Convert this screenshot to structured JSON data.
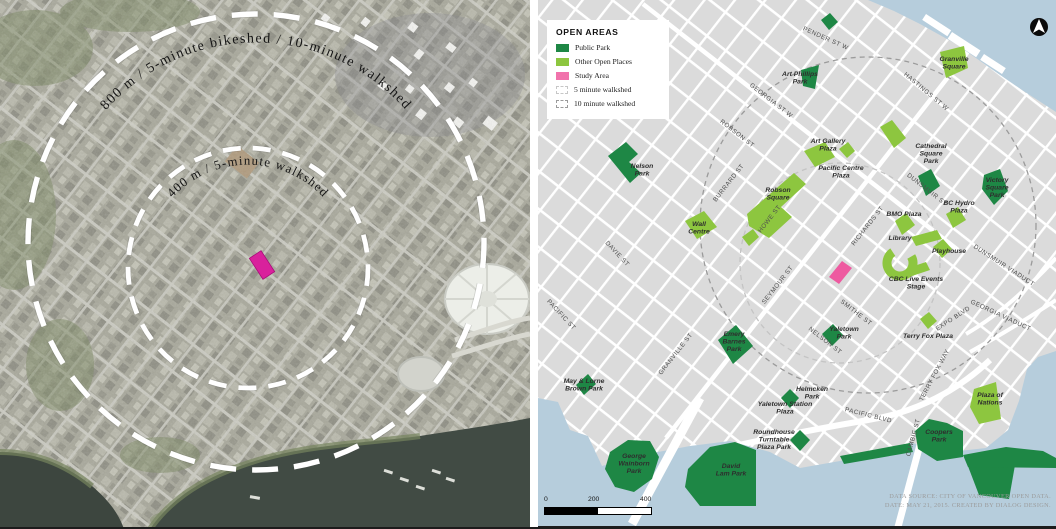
{
  "left_panel": {
    "outer_circle_label": "800 m / 5-minute bikeshed / 10-minute walkshed",
    "inner_circle_label": "400 m / 5-minute walkshed"
  },
  "legend": {
    "title": "OPEN AREAS",
    "items": [
      {
        "label": "Public Park",
        "swatch": "#1e8745"
      },
      {
        "label": "Other Open Places",
        "swatch": "#8dc63f"
      },
      {
        "label": "Study Area",
        "swatch": "#f173ac"
      },
      {
        "label": "5 minute walkshed",
        "swatch": "dashed-light"
      },
      {
        "label": "10 minute walkshed",
        "swatch": "dashed-dark"
      }
    ]
  },
  "map": {
    "street_labels": [
      "PENDER ST W",
      "HASTINGS ST W",
      "GEORGIA ST W",
      "ROBSON ST",
      "DUNSMUIR ST",
      "SMITHE ST",
      "NELSON ST",
      "DAVIE ST",
      "PACIFIC ST",
      "PACIFIC BLVD",
      "EXPO BLVD",
      "BURRARD ST",
      "HOWE ST",
      "SEYMOUR ST",
      "RICHARDS ST",
      "GRANVILLE ST",
      "CAMBIE ST",
      "TERRY FOX WAY",
      "DUNSMUIR VIADUCT",
      "GEORGIA VIADUCT"
    ],
    "public_parks": [
      "Art Phillips\nPark",
      "Nelson\nPark",
      "Cathedral\nSquare\nPark",
      "Victory\nSquare\nPark",
      "Emery\nBarnes\nPark",
      "Yaletown\nPark",
      "Helmcken\nPark",
      "May & Lorne\nBrown Park",
      "George\nWainborn\nPark",
      "David\nLam Park",
      "Coopers\nPark",
      "Roundhouse\nTurntable\nPlaza Park",
      "Yaletown Station\nPlaza"
    ],
    "open_places": [
      "Granville\nSquare",
      "Art Gallery\nPlaza",
      "Pacific Centre\nPlaza",
      "Robson\nSquare",
      "Wall\nCentre",
      "BMO Plaza",
      "BC Hydro\nPlaza",
      "Library",
      "Playhouse",
      "CBC Live Events\nStage",
      "Terry Fox Plaza",
      "Plaza of\nNations"
    ]
  },
  "scale_bar": {
    "ticks": [
      "0",
      "200",
      "400"
    ]
  },
  "source": {
    "line1": "DATA SOURCE: CITY OF VANCOUVER OPEN DATA.",
    "line2": "DATE: MAY 21, 2015. CREATED BY DIALOG DESIGN."
  },
  "colors": {
    "public_park": "#1e8745",
    "other_open_places": "#8dc63f",
    "study_area": "#f173ac",
    "water": "#b6cddc",
    "land": "#dbdbdb",
    "aerial_study_area": "#d9219c"
  }
}
